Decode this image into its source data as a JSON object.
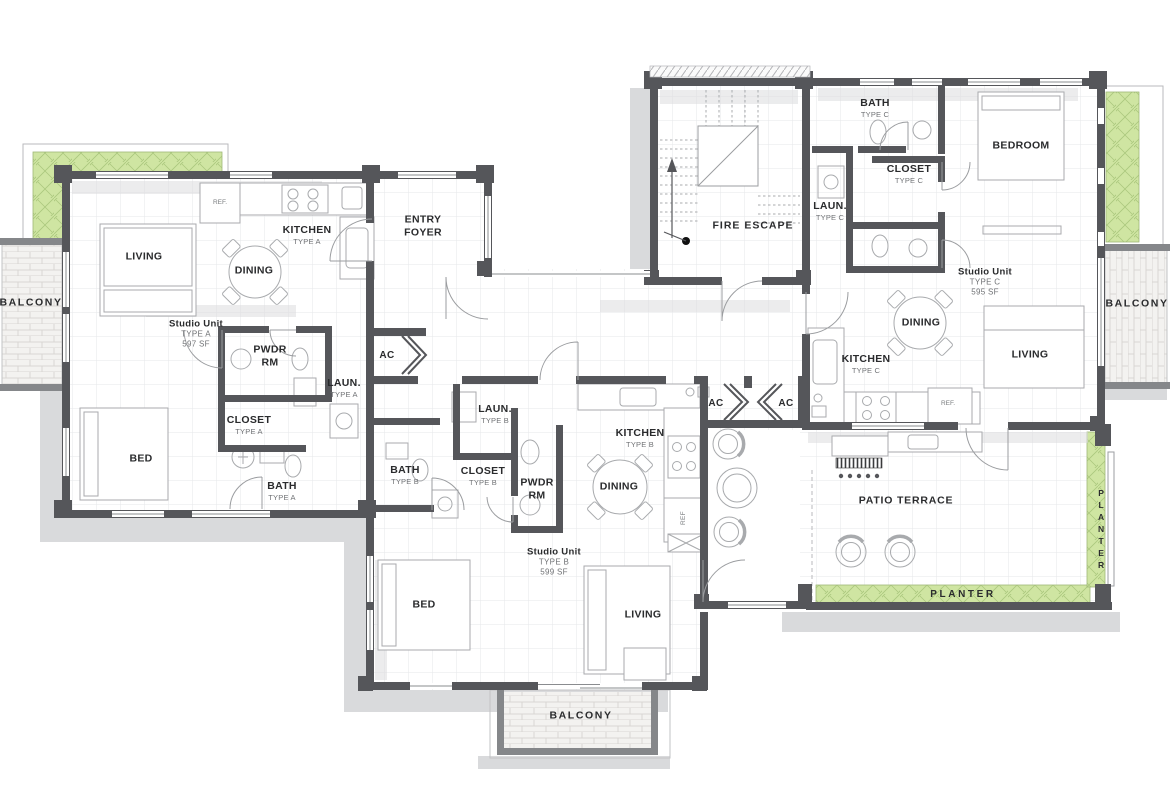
{
  "plan": {
    "colors": {
      "wall": "#55565a",
      "planter_green": "#cfe5a2",
      "shadow": "#d9dadc",
      "grid": "#e6e7ea",
      "text": "#2a2b2d",
      "muted": "#707275"
    },
    "units": {
      "a": {
        "name": "Studio Unit",
        "type": "TYPE A",
        "area": "597 SF"
      },
      "b": {
        "name": "Studio Unit",
        "type": "TYPE B",
        "area": "599 SF"
      },
      "c": {
        "name": "Studio Unit",
        "type": "TYPE C",
        "area": "595 SF"
      }
    },
    "rooms": {
      "living": "LIVING",
      "dining": "DINING",
      "kitchen": "KITCHEN",
      "type_a": "TYPE A",
      "type_b": "TYPE B",
      "type_c": "TYPE C",
      "ref_dot": "REF.",
      "ref": "REF",
      "pwdr_1": "PWDR",
      "pwdr_2": "RM",
      "laun": "LAUN.",
      "closet": "CLOSET",
      "bed": "BED",
      "bedroom": "BEDROOM",
      "bath": "BATH",
      "entry_1": "ENTRY",
      "entry_2": "FOYER",
      "ac": "AC",
      "fire_escape": "FIRE ESCAPE",
      "patio": "PATIO TERRACE",
      "planter": "PLANTER",
      "balcony": "BALCONY"
    }
  }
}
